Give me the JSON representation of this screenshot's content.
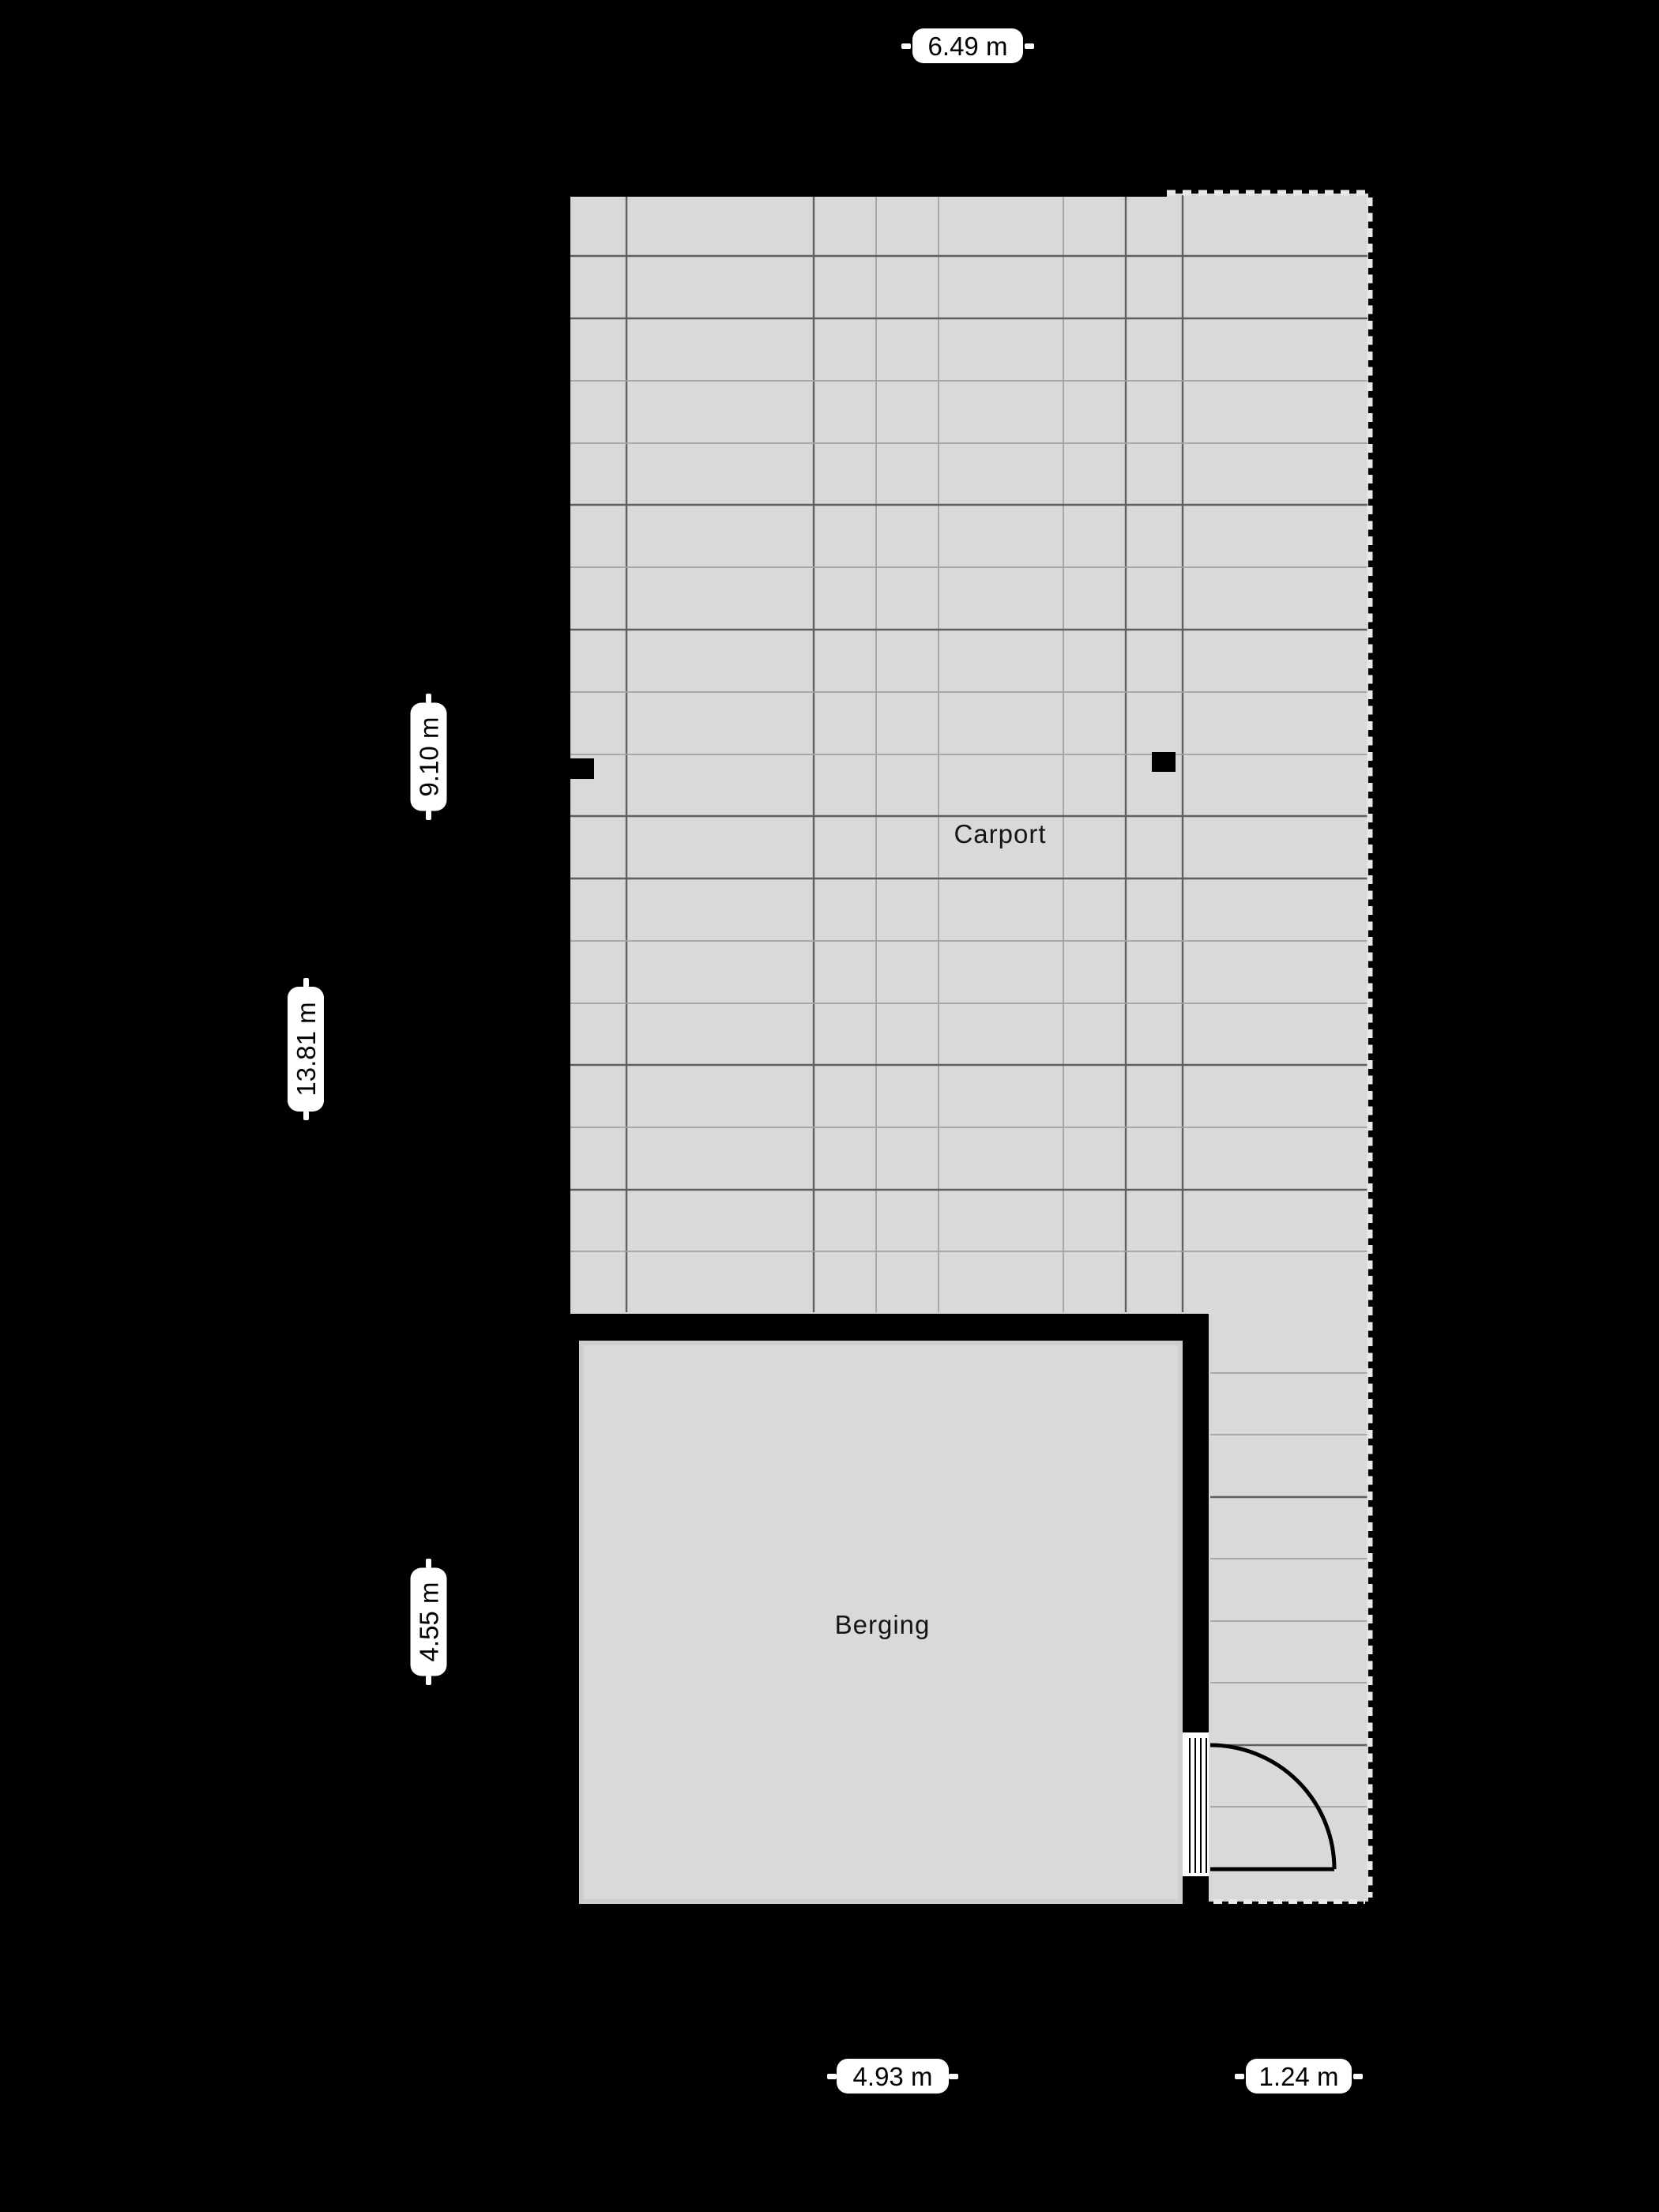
{
  "floorplan": {
    "background_color": "#000000",
    "floor_color": "#d9d9d9",
    "wall_color": "#000000",
    "label_bg_color": "#ffffff",
    "label_text_color": "#000000",
    "rooms": [
      {
        "name": "Carport"
      },
      {
        "name": "Berging"
      }
    ],
    "dimension_labels": {
      "top_width": "6.49 m",
      "carport_height": "9.10 m",
      "total_height": "13.81 m",
      "berging_height": "4.55 m",
      "berging_width": "4.93 m",
      "side_strip_width": "1.24 m"
    }
  }
}
